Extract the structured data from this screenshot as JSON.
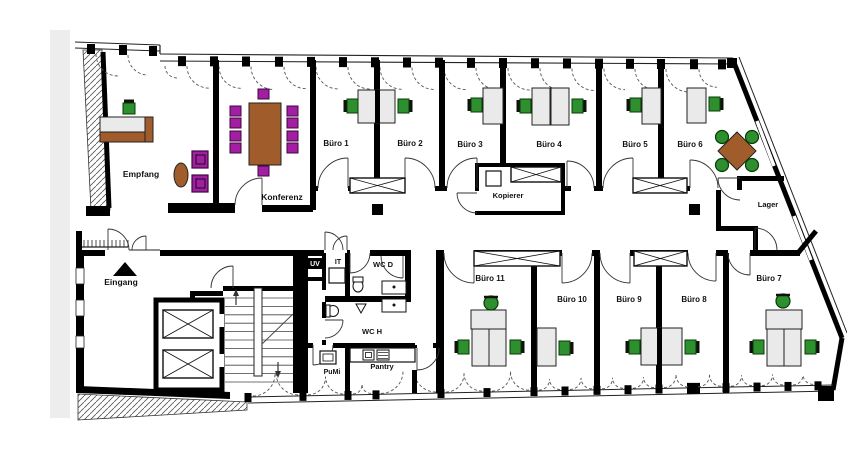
{
  "plan": {
    "language": "de",
    "rooms": [
      {
        "id": "empfang",
        "label": "Empfang",
        "x": 141,
        "y": 177,
        "fs": 8.5
      },
      {
        "id": "konferenz",
        "label": "Konferenz",
        "x": 282,
        "y": 200,
        "fs": 8.5
      },
      {
        "id": "buero-1",
        "label": "Büro 1",
        "x": 336,
        "y": 146,
        "fs": 8
      },
      {
        "id": "buero-2",
        "label": "Büro 2",
        "x": 410,
        "y": 146,
        "fs": 8
      },
      {
        "id": "buero-3",
        "label": "Büro 3",
        "x": 470,
        "y": 147,
        "fs": 8
      },
      {
        "id": "buero-4",
        "label": "Büro 4",
        "x": 549,
        "y": 147,
        "fs": 8
      },
      {
        "id": "buero-5",
        "label": "Büro 5",
        "x": 635,
        "y": 147,
        "fs": 8
      },
      {
        "id": "buero-6",
        "label": "Büro 6",
        "x": 690,
        "y": 147,
        "fs": 8
      },
      {
        "id": "buero-7",
        "label": "Büro 7",
        "x": 769,
        "y": 281,
        "fs": 8
      },
      {
        "id": "buero-8",
        "label": "Büro 8",
        "x": 694,
        "y": 302,
        "fs": 8
      },
      {
        "id": "buero-9",
        "label": "Büro 9",
        "x": 629,
        "y": 302,
        "fs": 8
      },
      {
        "id": "buero-10",
        "label": "Büro 10",
        "x": 572,
        "y": 302,
        "fs": 8
      },
      {
        "id": "buero-11",
        "label": "Büro 11",
        "x": 490,
        "y": 281,
        "fs": 8
      },
      {
        "id": "kopierer",
        "label": "Kopierer",
        "x": 508,
        "y": 198,
        "fs": 7.5
      },
      {
        "id": "lager",
        "label": "Lager",
        "x": 768,
        "y": 207,
        "fs": 7.5
      },
      {
        "id": "eingang",
        "label": "Eingang",
        "x": 121,
        "y": 285,
        "fs": 8.5
      },
      {
        "id": "wc-d",
        "label": "WC D",
        "x": 383,
        "y": 267,
        "fs": 7.5
      },
      {
        "id": "wc-h",
        "label": "WC H",
        "x": 372,
        "y": 334,
        "fs": 7.5
      },
      {
        "id": "pantry",
        "label": "Pantry",
        "x": 382,
        "y": 369,
        "fs": 7.5
      },
      {
        "id": "pumi",
        "label": "PuMi",
        "x": 332,
        "y": 374,
        "fs": 7
      },
      {
        "id": "it",
        "label": "IT",
        "x": 338,
        "y": 264,
        "fs": 7
      },
      {
        "id": "uv",
        "label": "UV",
        "x": 315,
        "y": 266,
        "fs": 7,
        "inverted": true
      }
    ],
    "symbols": {
      "entrance_marker": "triangle-up",
      "stairs": "double-run-with-up-down-arrows",
      "elevators": 2,
      "crossed_boxes": "cabinets / elevator cars",
      "dashed_arcs": "window openings"
    }
  },
  "colors": {
    "wall": "#000000",
    "floor": "#FFFFFF",
    "edge_strip": "#EDEDED",
    "desk_gray": "#EAEAEA",
    "chair_green": "#2E8F2E",
    "chair_purple": "#A21EA2",
    "table_brown": "#A15C2B",
    "hatch": "#555555",
    "door_arc": "#333333",
    "window_dash": "#555555"
  }
}
